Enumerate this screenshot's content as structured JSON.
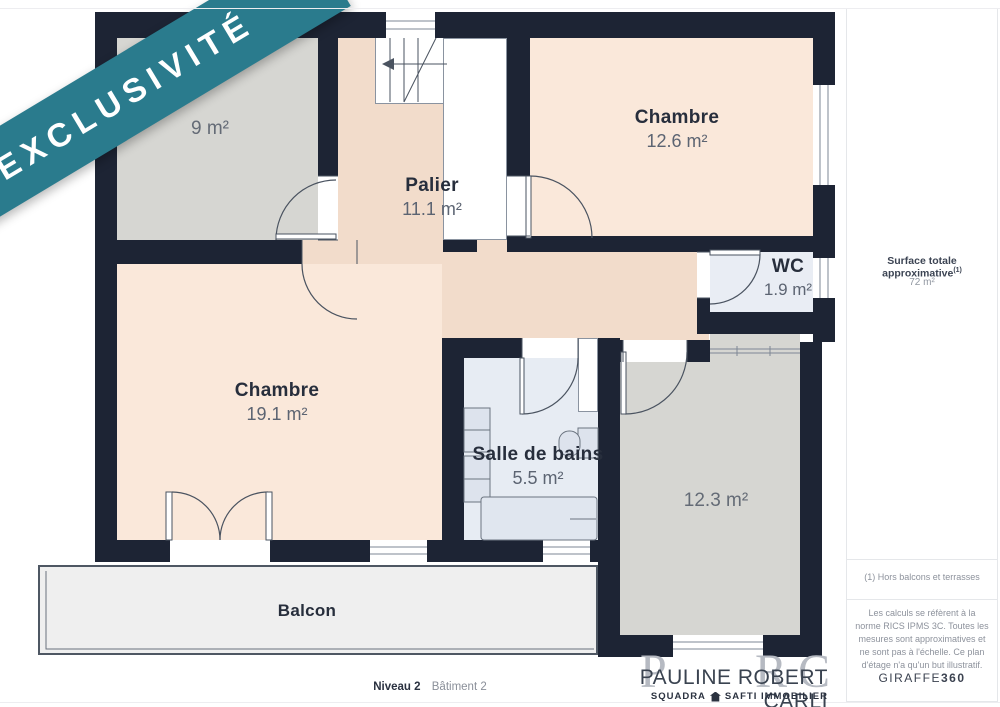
{
  "banner": {
    "label": "EXCLUSIVITÉ",
    "color": "#2a7b8d"
  },
  "plan": {
    "rooms": {
      "r9": {
        "name": "",
        "area": "9 m²"
      },
      "palier": {
        "name": "Palier",
        "area": "11.1 m²"
      },
      "chambre126": {
        "name": "Chambre",
        "area": "12.6 m²"
      },
      "wc": {
        "name": "WC",
        "area": "1.9 m²"
      },
      "chambre191": {
        "name": "Chambre",
        "area": "19.1 m²"
      },
      "sdb": {
        "name": "Salle de bains",
        "area": "5.5 m²"
      },
      "r123": {
        "name": "",
        "area": "12.3 m²"
      },
      "balcon": {
        "name": "Balcon",
        "area": ""
      }
    },
    "colors": {
      "wall": "#1d2434",
      "bedroom": "#fae8da",
      "landing": "#f2dccb",
      "grey_room": "#d6d6d2",
      "wet_room": "#e7ecf3",
      "balcony": "#efefef"
    }
  },
  "sidebar": {
    "surface_label": "Surface totale approximative",
    "surface_sup": "(1)",
    "surface_value": "72 m²",
    "footnote_1": "(1) Hors balcons et terrasses",
    "disclaimer": "Les calculs se réfèrent à la norme RICS IPMS 3C. Toutes les mesures sont approximatives et ne sont pas à l'échelle. Ce plan d'étage n'a qu'un but illustratif.",
    "brand": "GIRAFFE",
    "brand_suffix": "360"
  },
  "footer": {
    "level_label": "Niveau 2",
    "building_label": "Bâtiment 2",
    "initials": [
      "P",
      "R",
      "C"
    ],
    "agent_name": "PAULINE ROBERT CARLI",
    "agency_left": "SQUADRA",
    "agency_right": "SAFTI IMMOBILIER"
  }
}
